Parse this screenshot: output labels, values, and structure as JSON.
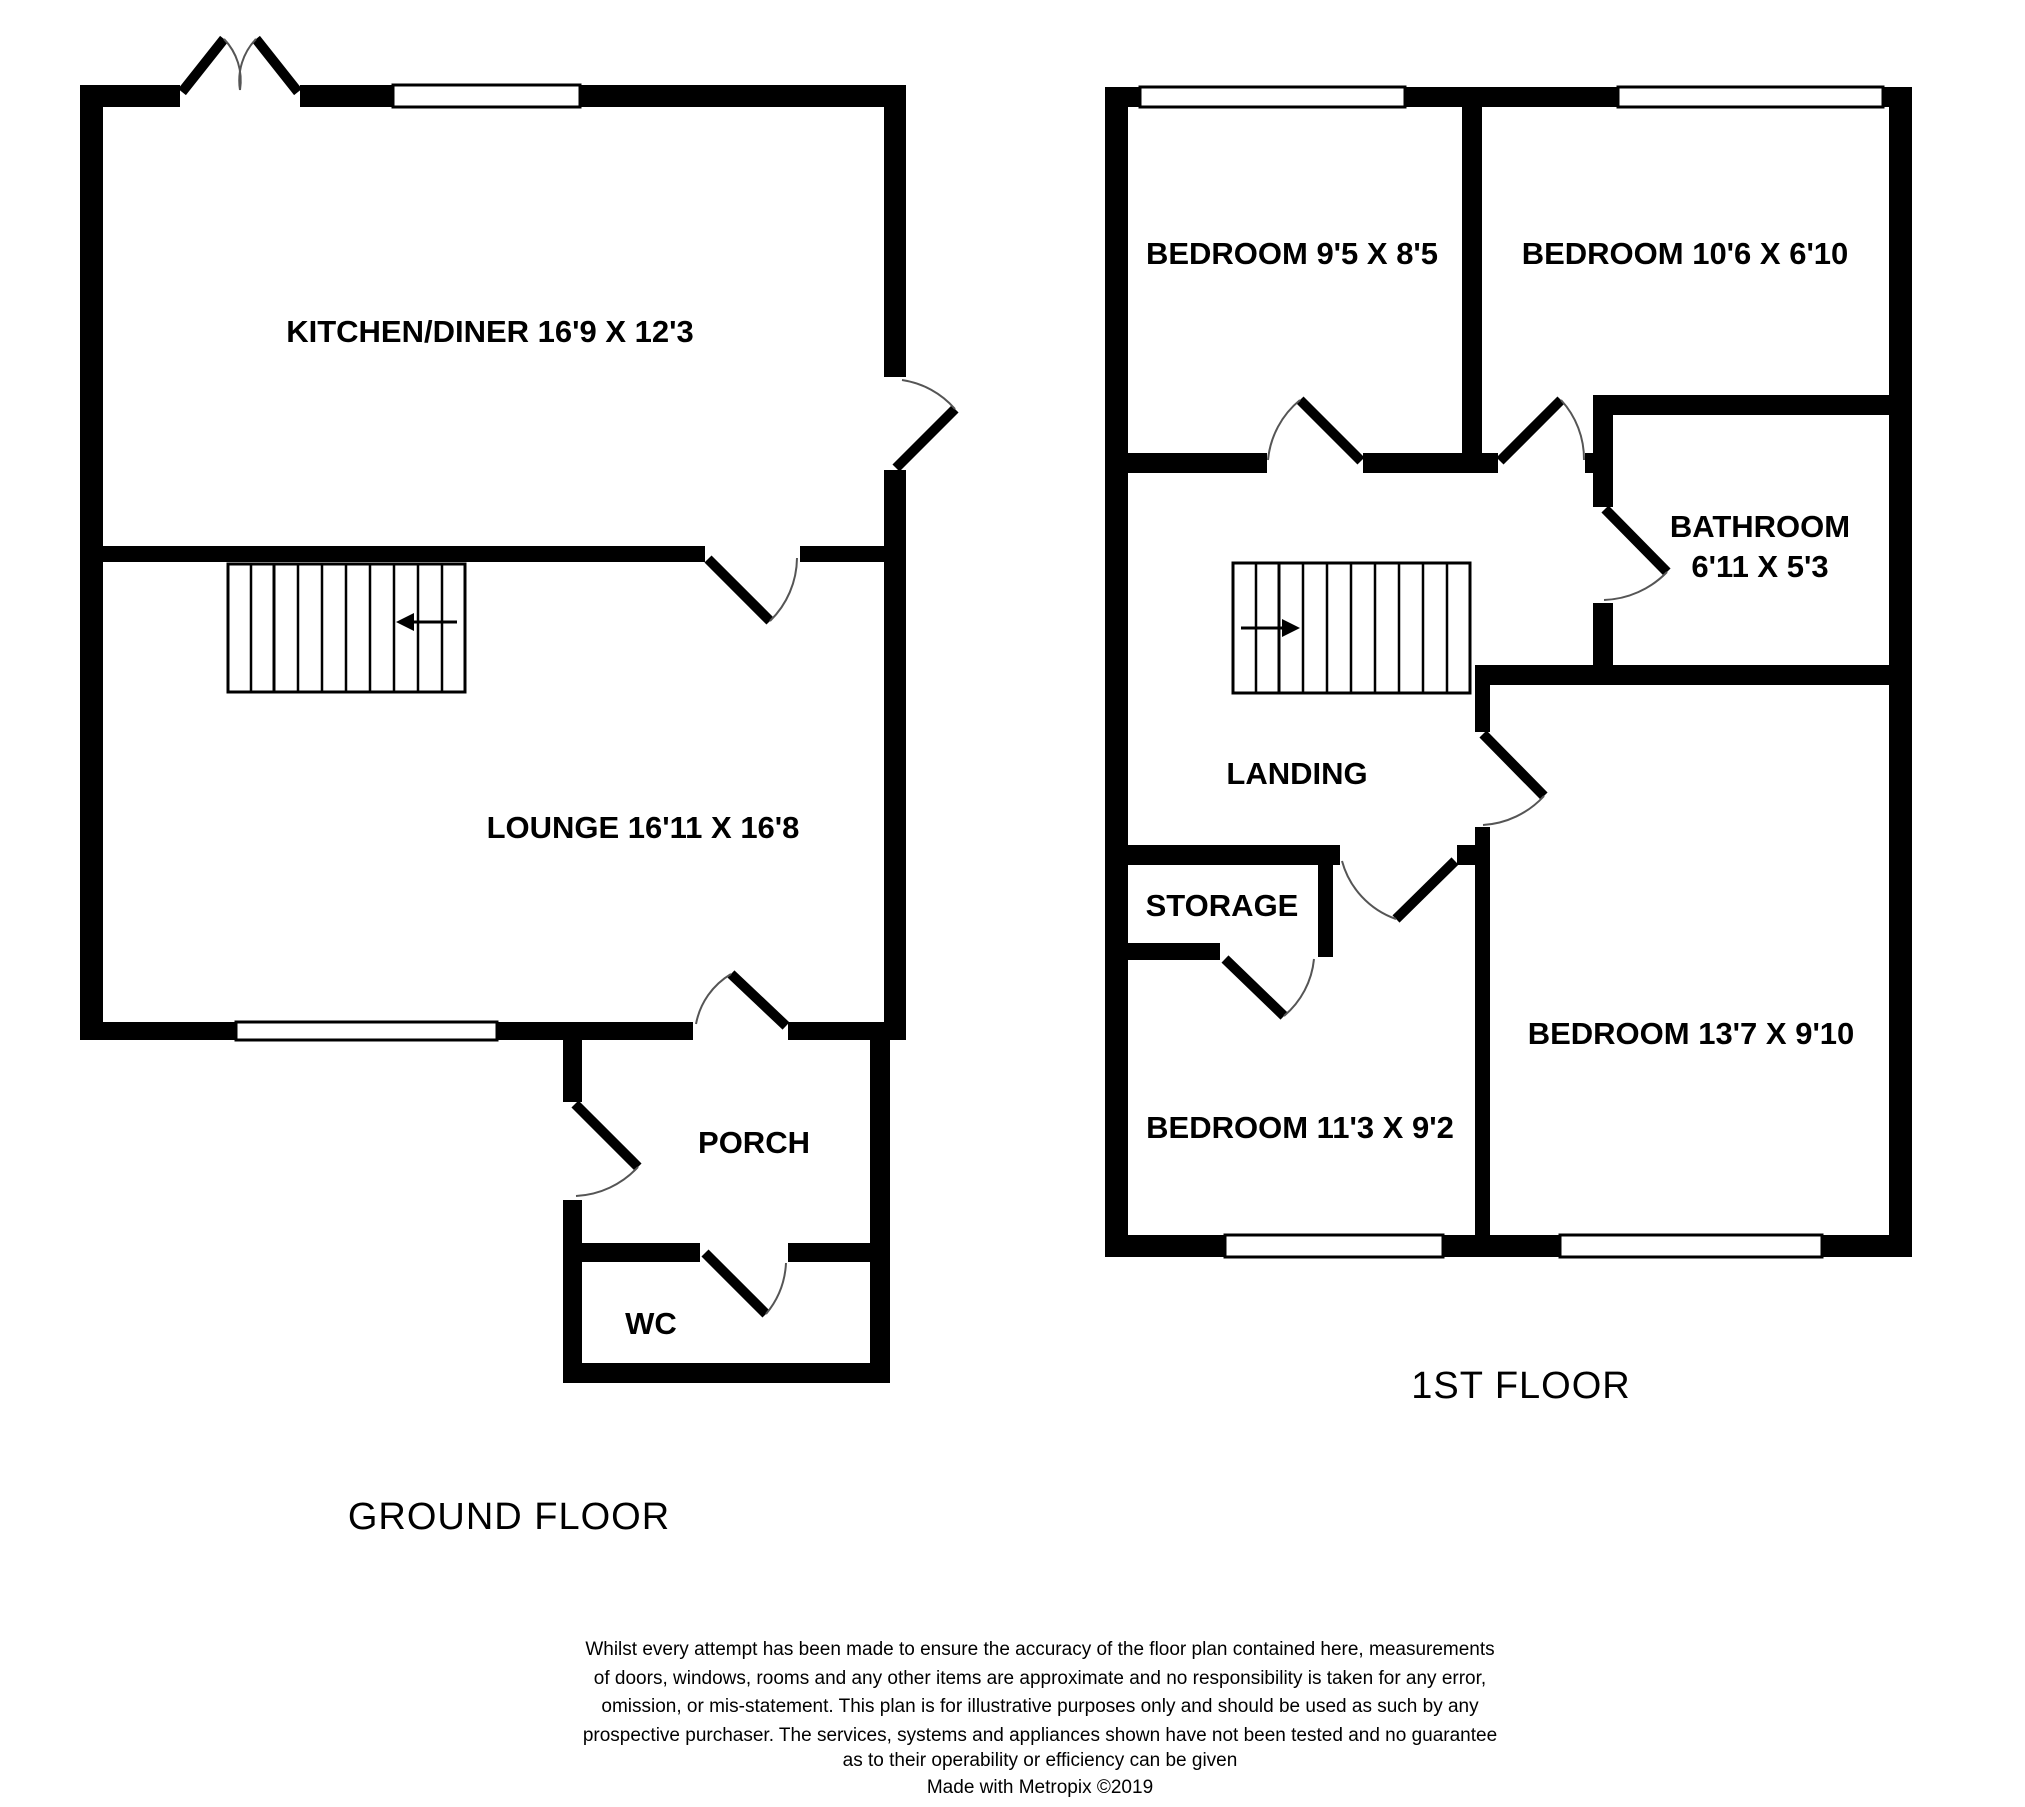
{
  "colors": {
    "background": "#ffffff",
    "wall": "#000000",
    "door_arc": "#555555"
  },
  "ground_floor": {
    "caption": "GROUND FLOOR",
    "rooms": {
      "kitchen_diner": "KITCHEN/DINER 16'9 X 12'3",
      "lounge": "LOUNGE 16'11 X 16'8",
      "porch": "PORCH",
      "wc": "WC"
    }
  },
  "first_floor": {
    "caption": "1ST FLOOR",
    "rooms": {
      "bedroom_1": "BEDROOM 9'5 X 8'5",
      "bedroom_2": "BEDROOM 10'6 X 6'10",
      "bathroom_name": "BATHROOM",
      "bathroom_size": "6'11 X 5'3",
      "landing": "LANDING",
      "storage": "STORAGE",
      "bedroom_3": "BEDROOM 11'3 X 9'2",
      "bedroom_4": "BEDROOM 13'7 X 9'10"
    }
  },
  "disclaimer": {
    "lines": [
      "Whilst every attempt has been made to ensure the accuracy of the floor plan contained here, measurements",
      "of doors, windows, rooms and any other items are approximate and no responsibility is taken for any error,",
      "omission, or mis-statement. This plan is for illustrative purposes only and should be used as such by any",
      "prospective purchaser. The services, systems and appliances shown have not been tested and no guarantee",
      "as to their operability or efficiency can be given",
      "Made with Metropix ©2019"
    ]
  }
}
